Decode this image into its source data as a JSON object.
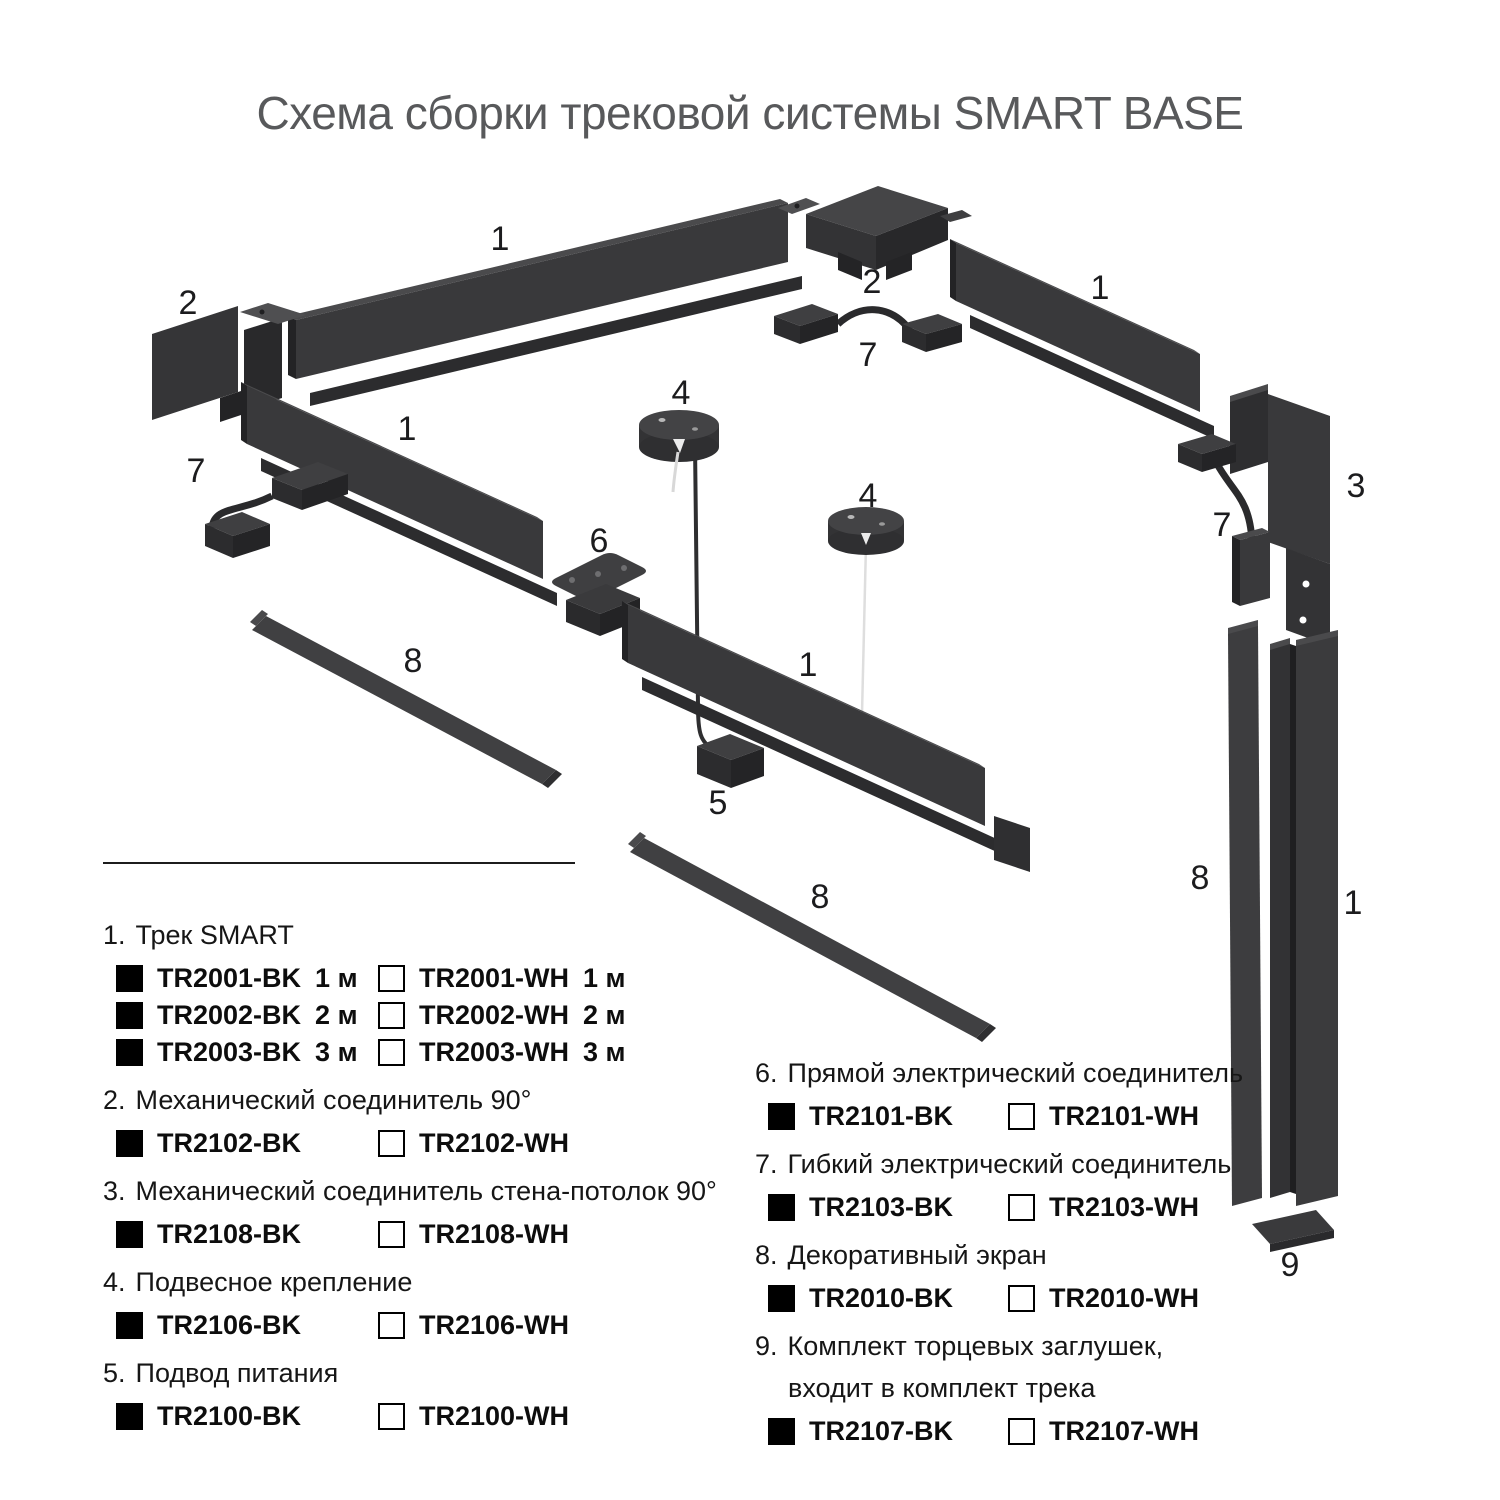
{
  "page": {
    "title": "Схема сборки трековой системы SMART BASE"
  },
  "colors": {
    "black_variant": "#000000",
    "white_variant": "#ffffff",
    "title_gray": "#58595b",
    "part_gray": "#39393b"
  },
  "diagram": {
    "labels": [
      "1",
      "2",
      "1",
      "7",
      "2",
      "7",
      "1",
      "4",
      "4",
      "6",
      "3",
      "7",
      "8",
      "1",
      "5",
      "8",
      "8",
      "1",
      "9"
    ]
  },
  "legend": {
    "items_left": [
      {
        "num": "1.",
        "title": "Трек SMART",
        "rows": [
          {
            "bk": "TR2001-BK",
            "bk_size": "1 м",
            "wh": "TR2001-WH",
            "wh_size": "1 м"
          },
          {
            "bk": "TR2002-BK",
            "bk_size": "2 м",
            "wh": "TR2002-WH",
            "wh_size": "2 м"
          },
          {
            "bk": "TR2003-BK",
            "bk_size": "3 м",
            "wh": "TR2003-WH",
            "wh_size": "3 м"
          }
        ]
      },
      {
        "num": "2.",
        "title": "Механический соединитель 90°",
        "rows": [
          {
            "bk": "TR2102-BK",
            "wh": "TR2102-WH"
          }
        ]
      },
      {
        "num": "3.",
        "title": "Механический соединитель стена-потолок 90°",
        "rows": [
          {
            "bk": "TR2108-BK",
            "wh": "TR2108-WH"
          }
        ]
      },
      {
        "num": "4.",
        "title": "Подвесное крепление",
        "rows": [
          {
            "bk": "TR2106-BK",
            "wh": "TR2106-WH"
          }
        ]
      },
      {
        "num": "5.",
        "title": "Подвод питания",
        "rows": [
          {
            "bk": "TR2100-BK",
            "wh": "TR2100-WH"
          }
        ]
      }
    ],
    "items_right": [
      {
        "num": "6.",
        "title": "Прямой электрический соединитель",
        "rows": [
          {
            "bk": "TR2101-BK",
            "wh": "TR2101-WH"
          }
        ]
      },
      {
        "num": "7.",
        "title": "Гибкий электрический соединитель",
        "rows": [
          {
            "bk": "TR2103-BK",
            "wh": "TR2103-WH"
          }
        ]
      },
      {
        "num": "8.",
        "title": "Декоративный экран",
        "rows": [
          {
            "bk": "TR2010-BK",
            "wh": "TR2010-WH"
          }
        ]
      },
      {
        "num": "9.",
        "title": "Комплект торцевых заглушек,",
        "title2": "входит в комплект трека",
        "rows": [
          {
            "bk": "TR2107-BK",
            "wh": "TR2107-WH"
          }
        ]
      }
    ]
  }
}
